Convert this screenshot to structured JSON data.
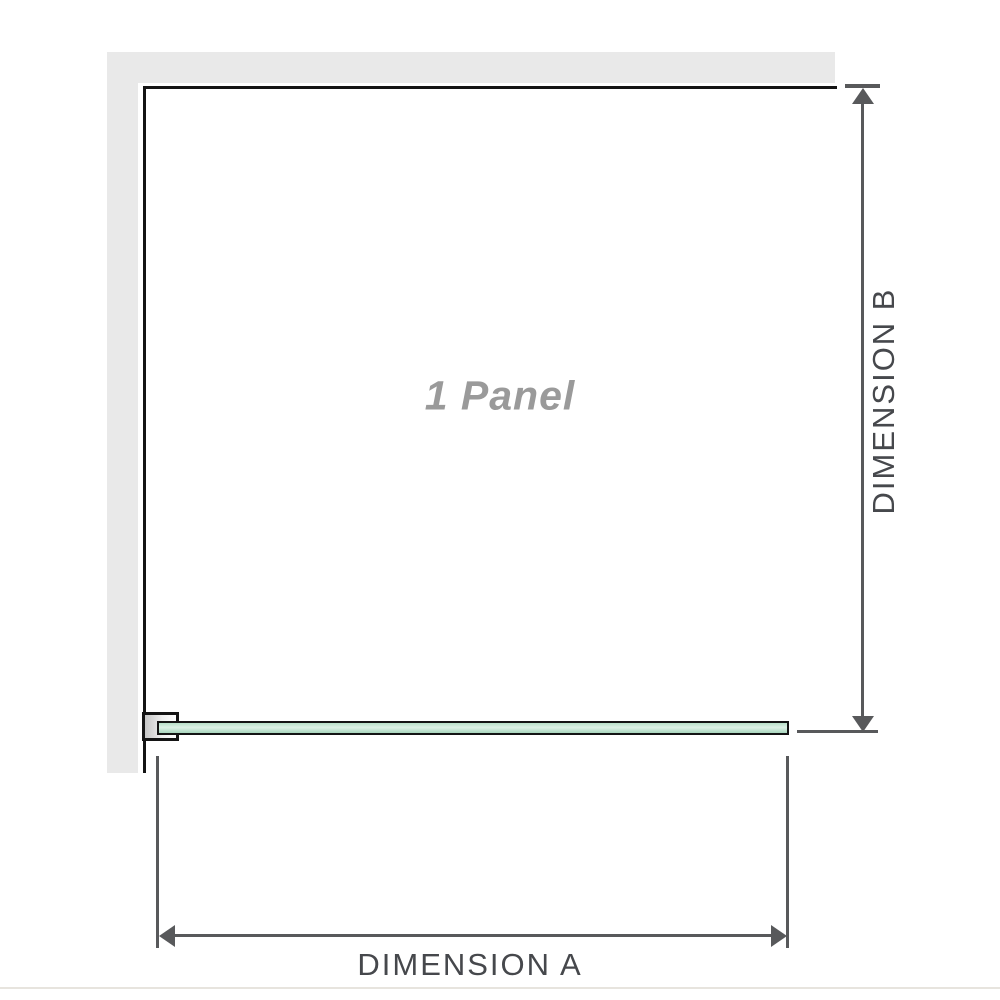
{
  "diagram": {
    "panel_label": "1 Panel",
    "dimension_a_label": "DIMENSION A",
    "dimension_b_label": "DIMENSION B"
  },
  "colors": {
    "wall": "#e9e9e9",
    "outline": "#141414",
    "glass_light": "#ddf1e6",
    "glass_mid": "#b7dfc8",
    "glass_deep": "#a8d6bc",
    "dim": "#58595b",
    "label_text": "#46484c",
    "panel_text": "#9a9a9a",
    "divider": "#e7e4de"
  }
}
